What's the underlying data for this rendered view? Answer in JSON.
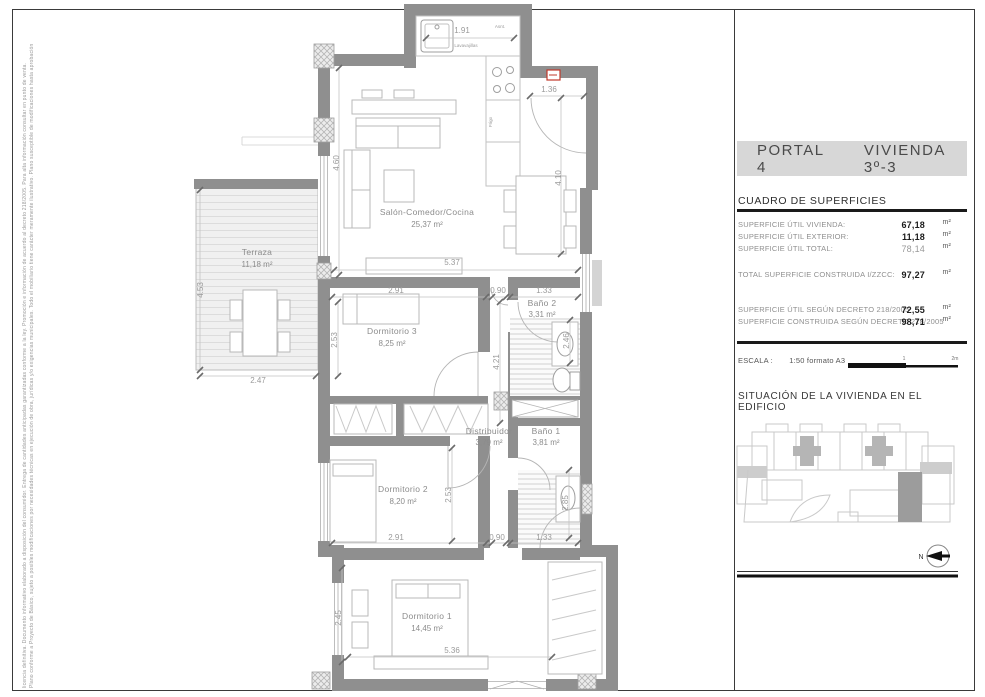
{
  "sheet": {
    "disclaimer_line1": "Plano conforme a Proyecto de Básico, sujeto a posibles modificaciones por necesidades técnicas en ejecución de obra, jurídicas y/o exigencias municipales. Todo el mobiliario tiene carácter meramente ilustrativo. Plano susceptible de modificaciones hasta aprobación",
    "disclaimer_line2": "licencia definitiva. Documento informativo elaborado a disposición del consumidor. Entrega de cantidades anticipadas garantizadas conforme a la ley. Promoción e información de acuerdo al decreto 218/2005. Para alta información consultar en punto de venta."
  },
  "title_block": {
    "portal": "PORTAL 4",
    "vivienda": "VIVIENDA 3º-3",
    "surfaces_title": "CUADRO DE SUPERFICIES",
    "rows": [
      {
        "label": "SUPERFICIE ÚTIL VIVIENDA:",
        "value": "67,18",
        "unit": "m²"
      },
      {
        "label": "SUPERFICIE ÚTIL EXTERIOR:",
        "value": "11,18",
        "unit": "m²"
      },
      {
        "label": "SUPERFICIE ÚTIL TOTAL:",
        "value": "78,14",
        "unit": "m²"
      },
      {
        "label": "TOTAL SUPERFICIE CONSTRUIDA I/ZZCC:",
        "value": "97,27",
        "unit": "m²"
      },
      {
        "label": "SUPERFICIE ÚTIL SEGÚN DECRETO 218/2005",
        "value": "72,55",
        "unit": "m²"
      },
      {
        "label": "SUPERFICIE CONSTRUIDA SEGÚN DECRETO 218/2005",
        "value": "98,71",
        "unit": "m²"
      }
    ],
    "escala_label": "ESCALA :",
    "escala_value": "1:50 formato A3",
    "scale_ticks": [
      "1",
      "2m"
    ],
    "situacion_title": "SITUACIÓN DE LA VIVIENDA EN EL EDIFICIO",
    "north_label": "N"
  },
  "plan": {
    "rooms": [
      {
        "name": "Terraza",
        "area": "11,18 m²"
      },
      {
        "name": "Salón-Comedor/Cocina",
        "area": "25,37 m²"
      },
      {
        "name": "Dormitorio 3",
        "area": "8,25 m²"
      },
      {
        "name": "Baño 2",
        "area": "3,31 m²"
      },
      {
        "name": "Distribuidor",
        "area": "3,79 m²"
      },
      {
        "name": "Baño 1",
        "area": "3,81 m²"
      },
      {
        "name": "Dormitorio 2",
        "area": "8,20 m²"
      },
      {
        "name": "Dormitorio 1",
        "area": "14,45 m²"
      }
    ],
    "kitchen": {
      "top_label": "Asnt.",
      "dishwasher": "Lavavajillas",
      "fridge": "Frigo"
    },
    "dims": {
      "kitchen_w": "1.91",
      "entry_w": "1.36",
      "salon_left_h": "4.60",
      "salon_right_h": "4.10",
      "salon_w": "5.37",
      "terraza_h": "4.53",
      "terraza_w": "2.47",
      "dorm3_w": "2.91",
      "hall_top_w": "0.90",
      "bano2_w": "1.33",
      "dorm3_h": "2.53",
      "bano2_h": "2.46",
      "hall_h": "4.21",
      "dorm2_h": "2.53",
      "bano1_h": "2.85",
      "dorm2_w": "2.91",
      "hall_bottom_w": "0.90",
      "bano1_w": "1.33",
      "dorm1_h": "2.45",
      "dorm1_w": "5.36"
    }
  },
  "colors": {
    "wall": "#8f8f8f",
    "accent_red": "#c0392b",
    "band_bg": "#d7d7d7",
    "highlight_unit": "#9c9c9c"
  }
}
